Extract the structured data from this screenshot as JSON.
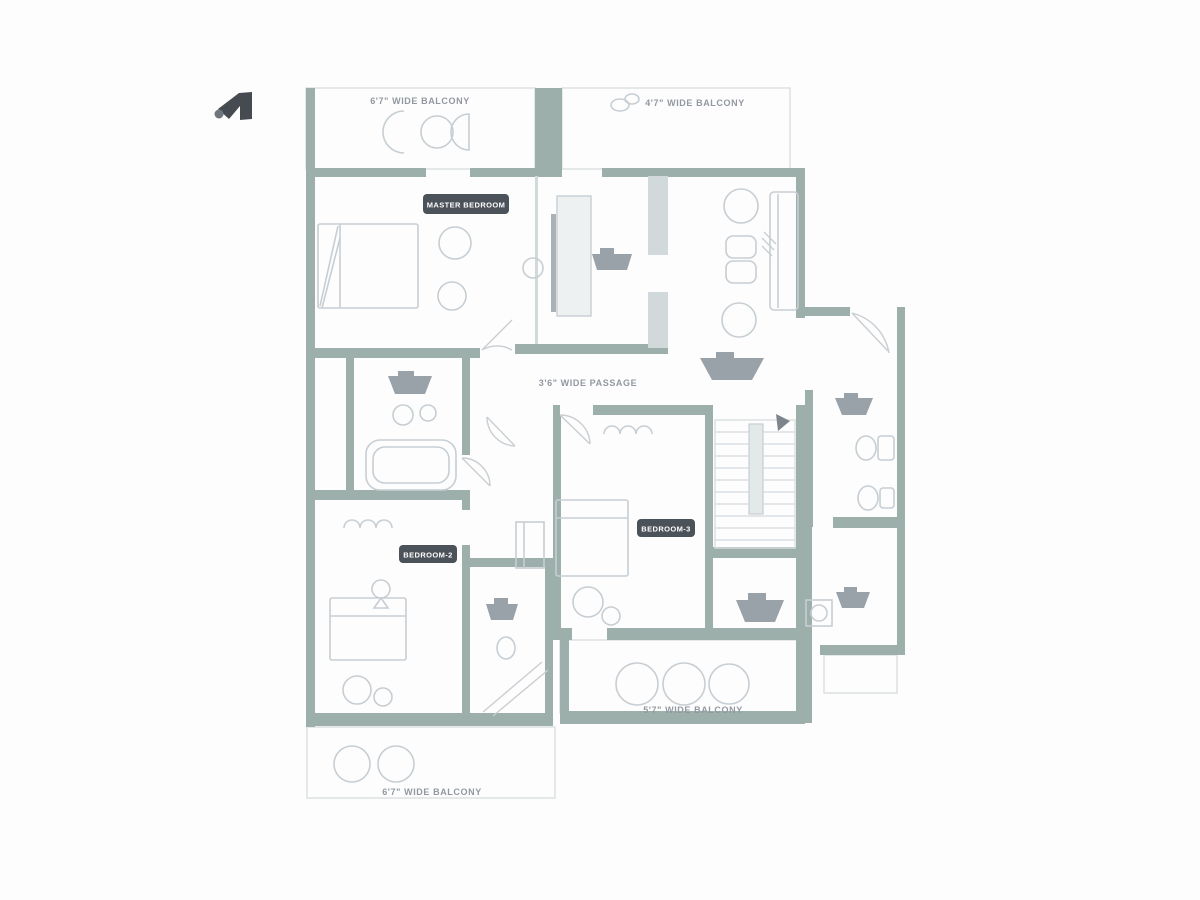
{
  "title": "apartment floor plan",
  "colors": {
    "wall": "#9cafab",
    "wall_light": "#d2d9db",
    "fixture_stroke": "#c7ced3",
    "fixture_dark": "#99a1a9",
    "chip_background": "#4c525a",
    "chip_text": "#ffffff",
    "label_text": "#9298a0",
    "background": "#fdfdfd"
  },
  "logo": {
    "name": "brand-mark"
  },
  "labels": {
    "balcony_top_left": "6'7\" WIDE BALCONY",
    "balcony_top_right": "4'7\" WIDE BALCONY",
    "balcony_bottom": "5'7\" WIDE BALCONY",
    "balcony_bottom_left": "6'7\" WIDE BALCONY",
    "passage": "3'6\" WIDE PASSAGE",
    "master_bedroom": "MASTER BEDROOM",
    "bedroom_2": "BEDROOM-2",
    "bedroom_3": "BEDROOM-3"
  }
}
